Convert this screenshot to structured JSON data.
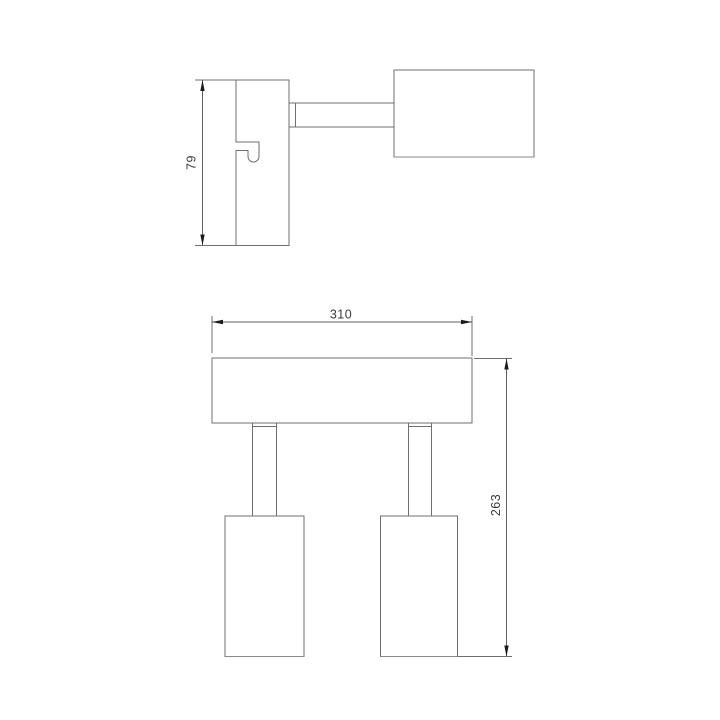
{
  "drawing": {
    "type": "technical-dimension-drawing",
    "subject": "two-head spot light fixture, side view and front view",
    "colors": {
      "background": "#ffffff",
      "outline": "#6f6f6f",
      "dimension_line": "#606060",
      "arrow": "#1c1c1c",
      "text": "#3a3a3a"
    },
    "views": {
      "side_view": {
        "parts": [
          "wall-bracket with hook slot",
          "swivel arm",
          "lamp head"
        ],
        "dimension_height": {
          "label": "79",
          "orientation": "vertical"
        }
      },
      "front_view": {
        "parts": [
          "mounting bar",
          "left stem",
          "right stem",
          "left lamp head",
          "right lamp head"
        ],
        "dimension_width": {
          "label": "310",
          "orientation": "horizontal"
        },
        "dimension_height": {
          "label": "263",
          "orientation": "vertical"
        }
      }
    }
  }
}
